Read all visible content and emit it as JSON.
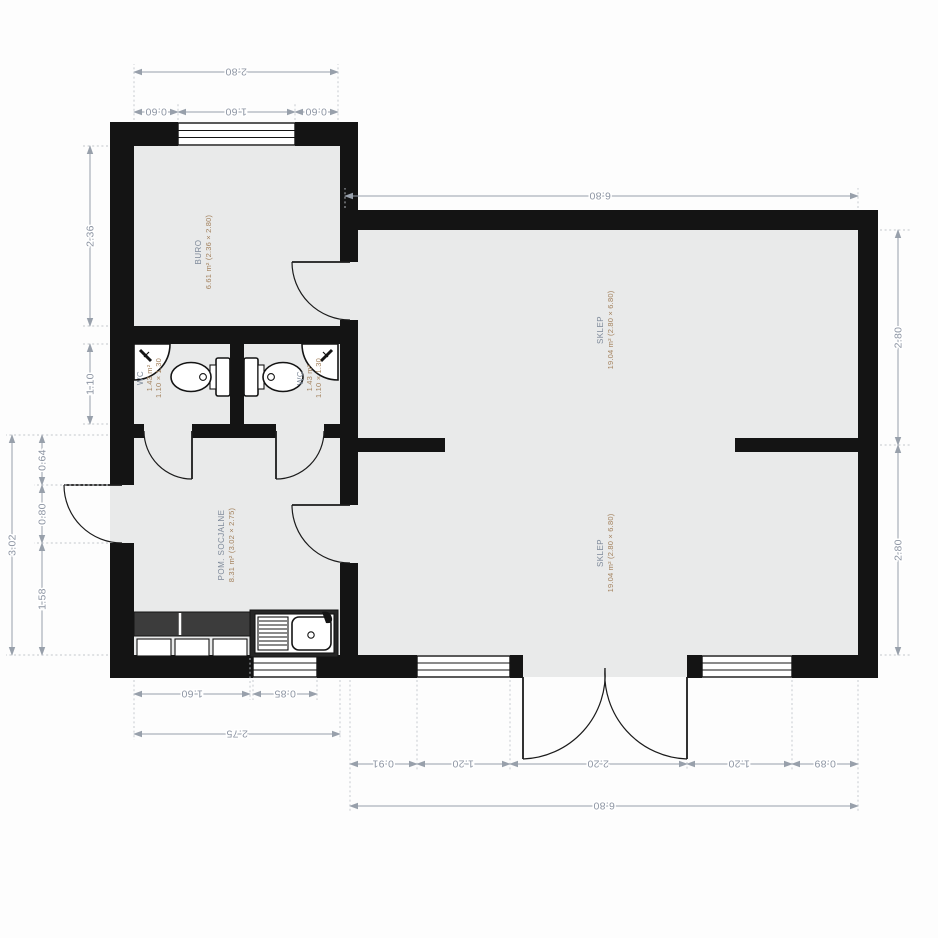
{
  "drawing": {
    "type": "floor-plan",
    "units": "m",
    "colors": {
      "wall": "#141414",
      "floor": "#e9eaea",
      "dimension_text": "#8d95a3",
      "room_name_text": "#7e8a9a",
      "room_area_text": "#a3825e"
    }
  },
  "rooms": [
    {
      "id": "buro",
      "name": "BURO",
      "area": "6.61 m² (2.36 × 2.80)"
    },
    {
      "id": "wc-left",
      "name": "WC",
      "area": "1.43 m²",
      "dims": "1.10 × 1.30"
    },
    {
      "id": "wc-right",
      "name": "WC",
      "area": "1.43 m²",
      "dims": "1.10 × 1.30"
    },
    {
      "id": "pom-socjalne",
      "name": "POM. SOCJALNE",
      "area": "8.31 m² (3.02 × 2.75)"
    },
    {
      "id": "sklep-upper",
      "name": "SKLEP",
      "area": "19.04 m² (2.80 × 6.80)"
    },
    {
      "id": "sklep-lower",
      "name": "SKLEP",
      "area": "19.04 m² (2.80 × 6.80)"
    }
  ],
  "dims": {
    "buro_width_total": "2.80",
    "buro_win_left": "0.60",
    "buro_win": "1.60",
    "buro_win_right": "0.60",
    "sklep_top_total": "6.80",
    "sklep_right_upper": "2.80",
    "sklep_right_lower": "2.80",
    "buro_height": "2.36",
    "wc_height": "1.10",
    "pom_height_total": "3.02",
    "pom_seg_top": "0.64",
    "entry_door": "0.80",
    "pom_seg_bottom": "1.58",
    "counter_width": "1.60",
    "window_left_width": "0.85",
    "pom_width_total": "2.75",
    "sb_1": "0.91",
    "sb_2": "1.20",
    "sb_3": "2.20",
    "sb_4": "1.20",
    "sb_5": "0.89",
    "sklep_bottom_total": "6.80"
  }
}
